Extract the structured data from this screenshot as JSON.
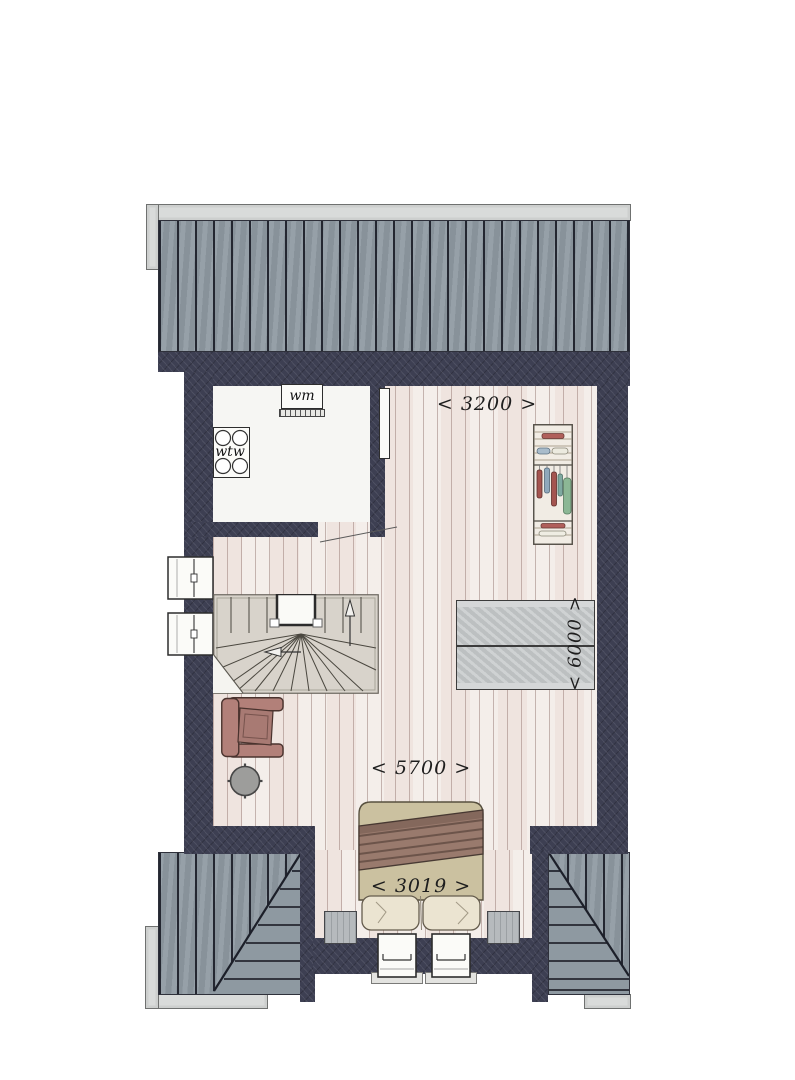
{
  "floorplan": {
    "dimensions": {
      "room_width_top": "< 3200 >",
      "total_width": "< 5700 >",
      "bed_width": "< 3019 >",
      "room_depth": "< 6000 >"
    },
    "appliances": {
      "washing_machine": "wm",
      "heat_recovery_unit": "wtw"
    },
    "colors": {
      "wall": "#3d3f52",
      "roof": "#8e99a1",
      "roof_line": "#242731",
      "floor": "#f3eeea",
      "gutter": "#d9dbda",
      "stairs": "#d8d3cb",
      "chair": "#b28079",
      "stool": "#9d9d9b",
      "bed_duvet": "#cbc1a0",
      "bed_blanket": "#997a6d",
      "pillow": "#ebe4d1",
      "roof_window": "#c5c8c9",
      "nightstand": "#b6babd"
    }
  }
}
